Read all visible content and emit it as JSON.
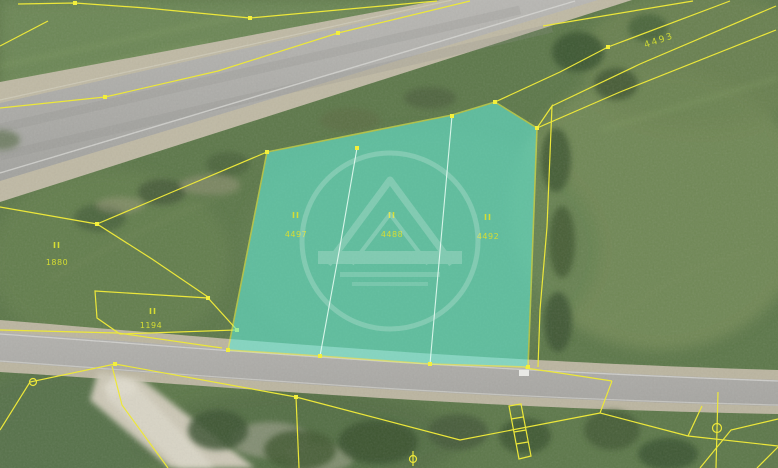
{
  "map": {
    "title": "cadastral-orthophoto-view",
    "parcels": {
      "p4497": {
        "code": "II",
        "number": "4497"
      },
      "p4488": {
        "code": "II",
        "number": "4488"
      },
      "p4492": {
        "code": "II",
        "number": "4492"
      },
      "p1880": {
        "code": "II",
        "number": "1880"
      },
      "p1194": {
        "code": "II",
        "number": "1194"
      },
      "p4493": {
        "number": "4493"
      }
    },
    "colors": {
      "highlight_fill": "#62ead6",
      "cadastral_line": "#ece73a",
      "label": "#d6dd33",
      "grass": "#5d784a",
      "asphalt": "#adaca8"
    },
    "markers": [
      "boundary-marker-circle",
      "boundary-marker-circle-stem",
      "boundary-marker-theta",
      "boundary-node-square"
    ],
    "watermark": {
      "name": "house-logo-watermark"
    }
  }
}
